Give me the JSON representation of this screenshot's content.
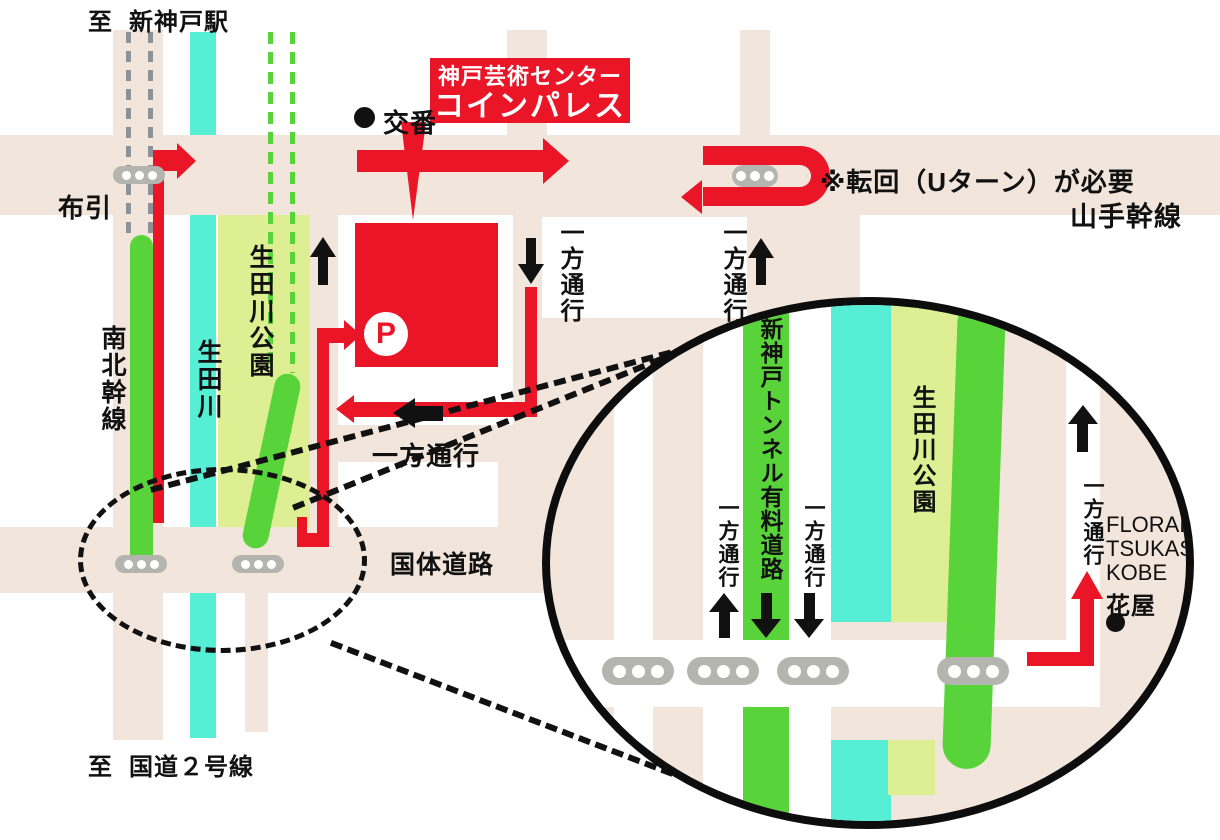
{
  "map_title": {
    "line1": "神戸芸術センター",
    "line2": "コインパレス"
  },
  "destinations": {
    "top_prefix": "至",
    "top_name": "新神戸駅",
    "bottom_prefix": "至",
    "bottom_name": "国道２号線"
  },
  "roads": {
    "yamate": "山手幹線",
    "kokutai": "国体道路",
    "nanboku": "南北幹線",
    "nunobiki": "布引",
    "river": "生田川",
    "park": "生田川公園",
    "tunnel_toll": "新神戸トンネル有料道路"
  },
  "labels": {
    "koban": "交番",
    "one_way": "一方通行",
    "uturn_note": "※転回（Uターン）が必要",
    "parking_mark": "P"
  },
  "shop": {
    "name_lines": [
      "FLORAL",
      "TSUKASA.",
      "KOBE"
    ],
    "type": "花屋"
  },
  "colors": {
    "road_beige": "#f2e5dc",
    "route_red": "#ea1527",
    "tunnel_green": "#58d43a",
    "river_cyan": "#56efd6",
    "park_green": "#ddef92",
    "signal_gray": "#b5b5af",
    "rail_dash_gray": "#8b9398"
  }
}
